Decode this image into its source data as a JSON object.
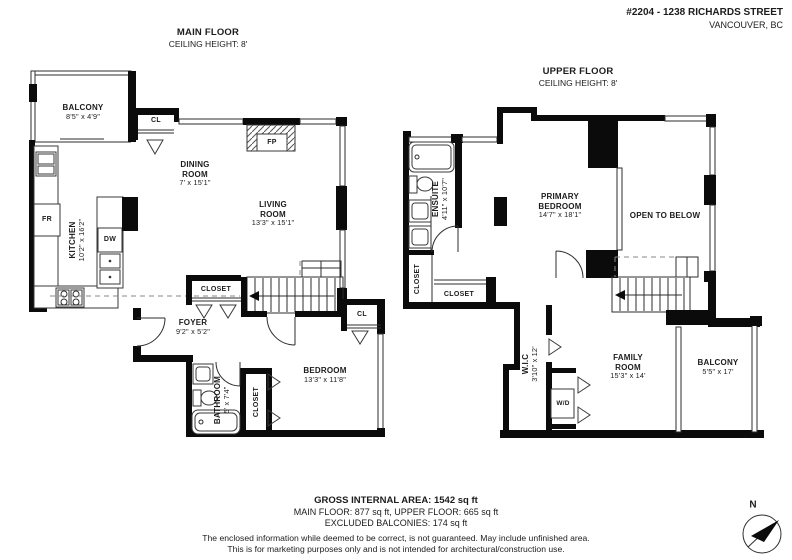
{
  "header": {
    "address_line1": "#2204 - 1238 RICHARDS STREET",
    "address_line2": "VANCOUVER, BC"
  },
  "main_floor": {
    "title": "MAIN FLOOR",
    "ceiling": "CEILING HEIGHT: 8'",
    "balcony_name": "BALCONY",
    "balcony_dims": "8'5\" x 4'9\"",
    "closet_top": "CL",
    "dining_name": "DINING ROOM",
    "dining_dims": "7' x 15'1\"",
    "living_name": "LIVING ROOM",
    "living_dims": "13'3\" x 15'1\"",
    "kitchen_name": "KITCHEN",
    "kitchen_dims": "10'2\" x 16'2\"",
    "fridge": "FR",
    "dishwasher": "DW",
    "fireplace": "FP",
    "closet_foyer": "CLOSET",
    "foyer_name": "FOYER",
    "foyer_dims": "9'2\" x 5'2\"",
    "bathroom_name": "BATHROOM",
    "bathroom_dims": "5' x 7'4\"",
    "closet_bedroom_vertical": "CLOSET",
    "bedroom_name": "BEDROOM",
    "bedroom_dims": "13'3\" x 11'8\"",
    "closet_bedroom": "CL"
  },
  "upper_floor": {
    "title": "UPPER FLOOR",
    "ceiling": "CEILING HEIGHT: 8'",
    "ensuite_name": "ENSUITE",
    "ensuite_dims": "4'11\" x 10'7\"",
    "closet_vertical": "CLOSET",
    "closet_horizontal": "CLOSET",
    "primary_name": "PRIMARY BEDROOM",
    "primary_dims": "14'7\" x 18'1\"",
    "open_to_below": "OPEN TO BELOW",
    "wic_name": "W.I.C",
    "wic_dims": "3'10\" x 12'",
    "washer_dryer": "W/D",
    "family_name": "FAMILY ROOM",
    "family_dims": "15'3\" x 14'",
    "balcony_name": "BALCONY",
    "balcony_dims": "5'5\" x 17'"
  },
  "footer": {
    "gross": "GROSS INTERNAL AREA: 1542 sq ft",
    "floors": "MAIN FLOOR: 877 sq ft, UPPER FLOOR: 665 sq ft",
    "balconies": "EXCLUDED BALCONIES: 174 sq ft",
    "disclaimer1": "The enclosed information while deemed to be correct, is not guaranteed. May include unfinished area.",
    "disclaimer2": "This is for marketing purposes only and is not intended for architectural/construction use."
  },
  "compass": {
    "north": "N"
  }
}
